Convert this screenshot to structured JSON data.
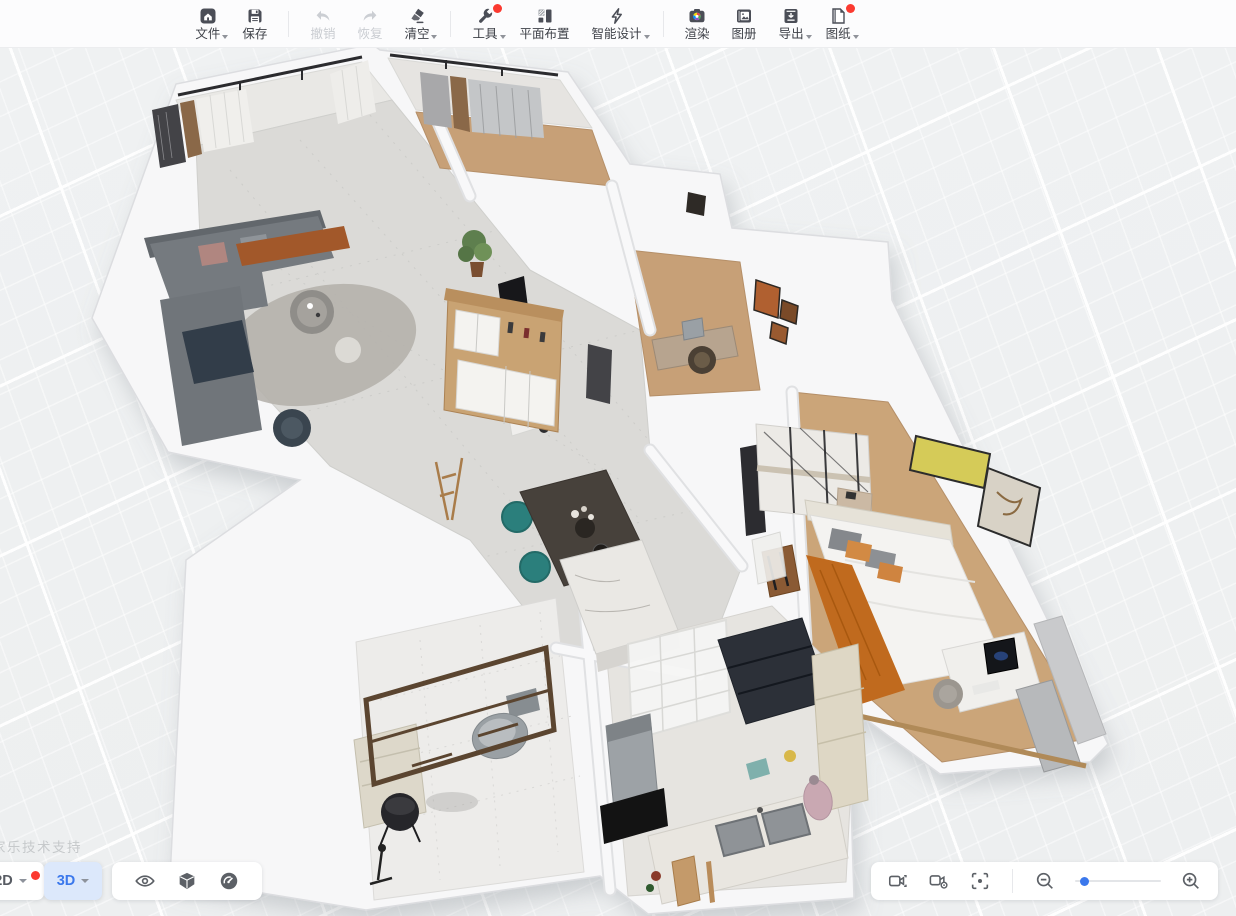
{
  "toolbar": {
    "file": {
      "label": "文件"
    },
    "save": {
      "label": "保存"
    },
    "undo": {
      "label": "撤销",
      "disabled": true
    },
    "redo": {
      "label": "恢复",
      "disabled": true
    },
    "clear": {
      "label": "清空"
    },
    "tools": {
      "label": "工具",
      "badge": true
    },
    "floor_plan": {
      "label": "平面布置"
    },
    "smart_design": {
      "label": "智能设计"
    },
    "render": {
      "label": "渲染"
    },
    "album": {
      "label": "图册"
    },
    "export": {
      "label": "导出"
    },
    "drawings": {
      "label": "图纸",
      "badge": true
    }
  },
  "viewport": {
    "watermark": "家乐技术支持"
  },
  "view_controls": {
    "mode_2d": "2D",
    "mode_3d": "3D",
    "active_mode": "3D",
    "has_2d_badge": true
  },
  "zoom_controls": {
    "slider_position_percent": 8
  },
  "colors": {
    "accent_blue": "#3b78ec",
    "badge_red": "#fb3a30",
    "chip_3d_bg": "#dce8fb",
    "toolbar_icon": "#4b4e57",
    "disabled_gray": "#c9ccd1",
    "viewport_bg": "#eef0f1",
    "wood_floor": "#c7a077",
    "dining_chair_teal": "#2b7f7c",
    "bed_runner_orange": "#c06a1e"
  }
}
